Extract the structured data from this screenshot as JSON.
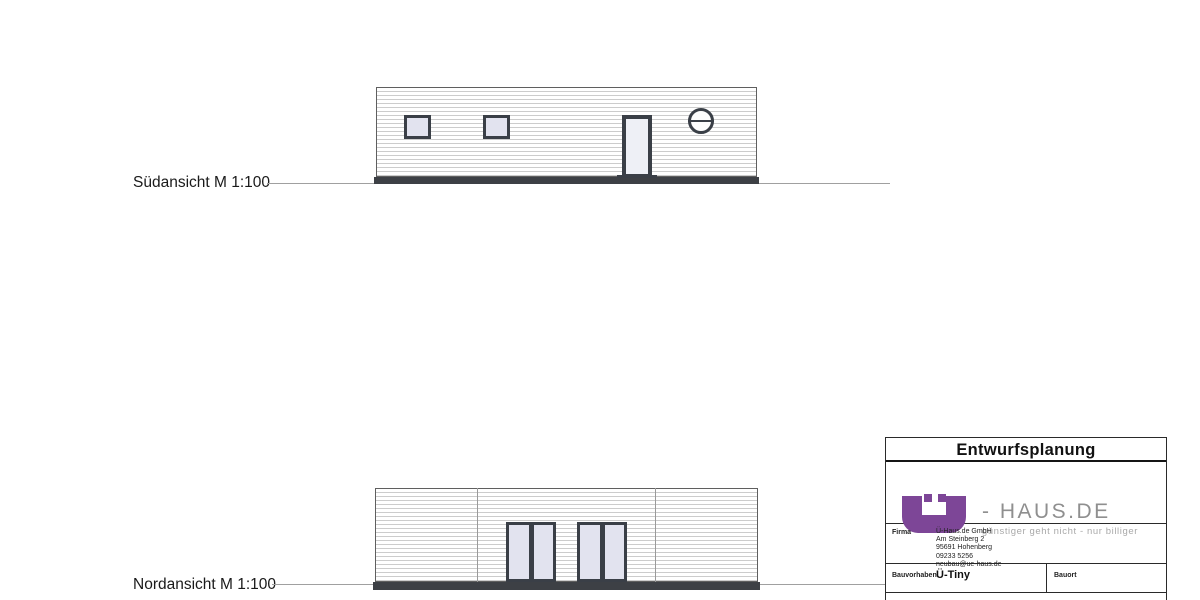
{
  "south_elevation": {
    "label": "Südansicht M 1:100"
  },
  "north_elevation": {
    "label": "Nordansicht M 1:100"
  },
  "title_block": {
    "title": "Entwurfsplanung",
    "logo": {
      "glyph": "Ü",
      "brand": "- HAUS.DE",
      "tagline": "günstiger geht nicht - nur billiger"
    },
    "firma": {
      "label": "Firma",
      "lines": [
        "Ü-Haus.de GmbH",
        "Am Steinberg 2",
        "95691 Hohenberg",
        "09233 5256",
        "neubau@ue-haus.de"
      ]
    },
    "bauvorhaben": {
      "label": "Bauvorhaben",
      "value": "Ü-Tiny"
    },
    "bauort": {
      "label": "Bauort",
      "value": ""
    }
  },
  "colors": {
    "frame_dark": "#3a3f47",
    "glass": "#e2e3ef",
    "plinth": "#3d4045",
    "logo_purple": "#7d4697",
    "brand_gray": "#8f8f8f",
    "tagline_gray": "#a9a9a9"
  }
}
